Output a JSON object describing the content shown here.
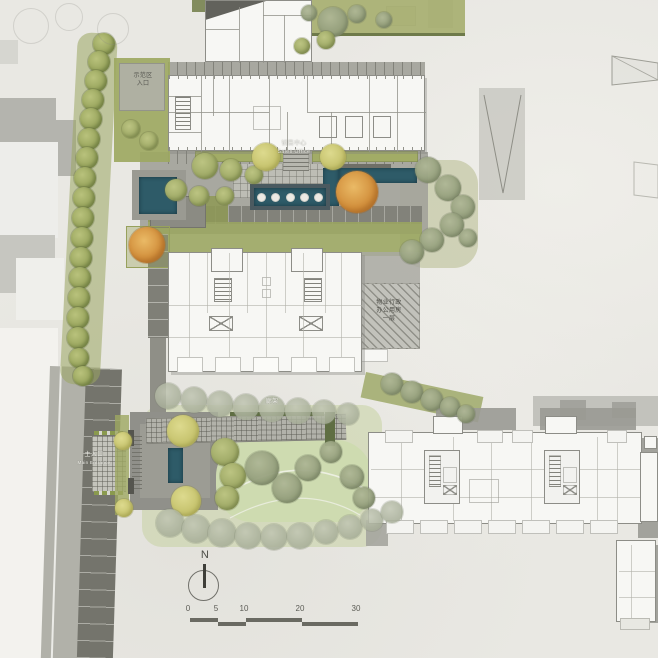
{
  "title": "住宅景观总平面图",
  "labels": {
    "sales_office_cn": "销售中心",
    "sales_office_en": "Sales Office",
    "property_office_l1": "物业行政",
    "property_office_l2": "办公用房",
    "property_office_l3": "一层",
    "main_entrance_cn": "主入口",
    "main_entrance_en": "Main Entrance",
    "annex_l1": "示范区",
    "annex_l2": "入口",
    "pergola": "廊架",
    "north": "N"
  },
  "scale_bar": {
    "ticks": [
      "0",
      "5",
      "10",
      "20",
      "30"
    ]
  },
  "palette": {
    "paper": "#e9e8e3",
    "water": "#2e5b68",
    "foliage_olive": "#9aa562",
    "foliage_sage": "#8f9a77",
    "foliage_yellow": "#d6d688",
    "foliage_orange": "#d2913f",
    "road_dark": "#74746c",
    "road_light": "#b1b1a9",
    "plan_fill": "#f7f7f4",
    "plan_wall": "#8d8d87",
    "hatch_fill": "#c2c2bb",
    "lawn": "#cedbb0"
  },
  "landscape": {
    "trees": [
      [
        104,
        44,
        11,
        "edge"
      ],
      [
        99,
        62,
        11,
        "edge"
      ],
      [
        96,
        81,
        11,
        "edge"
      ],
      [
        93,
        100,
        11,
        "edge"
      ],
      [
        91,
        119,
        11,
        "edge"
      ],
      [
        89,
        139,
        11,
        "edge"
      ],
      [
        87,
        158,
        11,
        "edge"
      ],
      [
        85,
        178,
        11,
        "edge"
      ],
      [
        84,
        198,
        11,
        "edge"
      ],
      [
        83,
        218,
        11,
        "edge"
      ],
      [
        82,
        238,
        11,
        "edge"
      ],
      [
        81,
        258,
        11,
        "edge"
      ],
      [
        80,
        278,
        11,
        "edge"
      ],
      [
        79,
        298,
        11,
        "edge"
      ],
      [
        78,
        318,
        11,
        "edge"
      ],
      [
        78,
        338,
        11,
        "edge"
      ],
      [
        79,
        358,
        10,
        "edge"
      ],
      [
        83,
        376,
        10,
        "edge"
      ],
      [
        333,
        22,
        15,
        "sage"
      ],
      [
        357,
        14,
        9,
        "sage"
      ],
      [
        309,
        13,
        8,
        "sage"
      ],
      [
        384,
        20,
        8,
        "sage"
      ],
      [
        30,
        25,
        17,
        "outline"
      ],
      [
        68,
        16,
        13,
        "outline"
      ],
      [
        112,
        28,
        15,
        "outline"
      ],
      [
        428,
        170,
        13,
        "sage"
      ],
      [
        448,
        188,
        13,
        "sage"
      ],
      [
        463,
        207,
        12,
        "sage"
      ],
      [
        452,
        225,
        12,
        "sage"
      ],
      [
        432,
        240,
        12,
        "sage"
      ],
      [
        412,
        252,
        12,
        "sage"
      ],
      [
        468,
        238,
        9,
        "sage"
      ],
      [
        205,
        166,
        13,
        "olive"
      ],
      [
        231,
        170,
        11,
        "olive"
      ],
      [
        254,
        175,
        9,
        "olive"
      ],
      [
        176,
        190,
        11,
        "olive"
      ],
      [
        199,
        196,
        10,
        "olive"
      ],
      [
        225,
        196,
        9,
        "olive"
      ],
      [
        131,
        129,
        9,
        "olive"
      ],
      [
        149,
        141,
        9,
        "olive"
      ],
      [
        326,
        40,
        9,
        "olive"
      ],
      [
        302,
        46,
        8,
        "olive"
      ],
      [
        266,
        157,
        14,
        "lime"
      ],
      [
        333,
        157,
        13,
        "lime"
      ],
      [
        357,
        192,
        21,
        "orange"
      ],
      [
        147,
        245,
        18,
        "orange"
      ],
      [
        168,
        396,
        13,
        "faded"
      ],
      [
        194,
        400,
        13,
        "faded"
      ],
      [
        220,
        404,
        13,
        "faded"
      ],
      [
        246,
        407,
        13,
        "faded"
      ],
      [
        272,
        409,
        13,
        "faded"
      ],
      [
        298,
        411,
        13,
        "faded"
      ],
      [
        324,
        412,
        12,
        "faded"
      ],
      [
        348,
        414,
        11,
        "faded"
      ],
      [
        392,
        384,
        11,
        "sage"
      ],
      [
        412,
        392,
        11,
        "sage"
      ],
      [
        432,
        400,
        11,
        "sage"
      ],
      [
        450,
        407,
        10,
        "sage"
      ],
      [
        466,
        414,
        9,
        "sage"
      ],
      [
        183,
        431,
        16,
        "lime"
      ],
      [
        186,
        501,
        15,
        "lime"
      ],
      [
        123,
        441,
        9,
        "lime"
      ],
      [
        124,
        508,
        9,
        "lime"
      ],
      [
        225,
        452,
        14,
        "olive"
      ],
      [
        233,
        476,
        13,
        "olive"
      ],
      [
        227,
        498,
        12,
        "olive"
      ],
      [
        262,
        468,
        17,
        "sage"
      ],
      [
        287,
        488,
        15,
        "sage"
      ],
      [
        308,
        468,
        13,
        "sage"
      ],
      [
        331,
        452,
        11,
        "sage"
      ],
      [
        352,
        477,
        12,
        "sage"
      ],
      [
        364,
        498,
        11,
        "sage"
      ],
      [
        170,
        523,
        14,
        "faded"
      ],
      [
        196,
        529,
        14,
        "faded"
      ],
      [
        222,
        533,
        14,
        "faded"
      ],
      [
        248,
        536,
        13,
        "faded"
      ],
      [
        274,
        537,
        13,
        "faded"
      ],
      [
        300,
        536,
        13,
        "faded"
      ],
      [
        326,
        532,
        12,
        "faded"
      ],
      [
        350,
        527,
        12,
        "faded"
      ],
      [
        372,
        520,
        11,
        "faded"
      ],
      [
        392,
        512,
        11,
        "faded"
      ]
    ]
  }
}
